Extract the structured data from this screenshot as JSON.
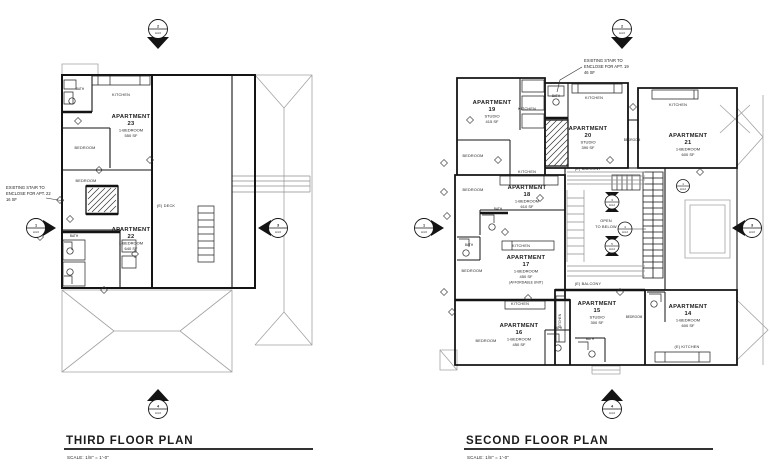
{
  "drawing": {
    "wall_color": "#141414",
    "roof_line_color": "#a3a3a3",
    "text_color": "#1c1c1c",
    "background": "#ffffff"
  },
  "plans": {
    "third": {
      "title": "THIRD FLOOR PLAN",
      "scale_label": "SCALE:   1/8\" = 1'-0\"",
      "annotation": {
        "line1": "EXISTING STAIR TO",
        "line2": "ENCLOSE FOR APT. 22",
        "line3": "16 SF"
      },
      "apartments": [
        {
          "label": "APARTMENT",
          "number": "23",
          "type": "1-BEDROOM",
          "area": "550 SF"
        },
        {
          "label": "APARTMENT",
          "number": "22",
          "type": "1-BEDROOM",
          "area": "640 SF"
        }
      ],
      "rooms": {
        "kitchen23": "KITCHEN",
        "bath23": "BATH",
        "bedroom23": "BEDROOM",
        "bedroom22": "BEDROOM",
        "bath22": "BATH",
        "deck": "(E) DECK"
      }
    },
    "second": {
      "title": "SECOND FLOOR PLAN",
      "scale_label": "SCALE:   1/8\" = 1'-0\"",
      "annotation": {
        "line1": "EXISTING STAIR TO",
        "line2": "ENCLOSE FOR APT. 19",
        "line3": "46 SF"
      },
      "apartments": [
        {
          "label": "APARTMENT",
          "number": "19",
          "type": "STUDIO",
          "area": "415 SF"
        },
        {
          "label": "APARTMENT",
          "number": "20",
          "type": "STUDIO",
          "area": "390 SF"
        },
        {
          "label": "APARTMENT",
          "number": "21",
          "type": "1-BEDROOM",
          "area": "600 SF"
        },
        {
          "label": "APARTMENT",
          "number": "18",
          "type": "1-BEDROOM",
          "area": "610 SF"
        },
        {
          "label": "APARTMENT",
          "number": "17",
          "type": "1-BEDROOM",
          "area": "450 SF",
          "note": "(AFFORDABLE UNIT)"
        },
        {
          "label": "APARTMENT",
          "number": "16",
          "type": "1-BEDROOM",
          "area": "450 SF"
        },
        {
          "label": "APARTMENT",
          "number": "15",
          "type": "STUDIO",
          "area": "300 SF"
        },
        {
          "label": "APARTMENT",
          "number": "14",
          "type": "1-BEDROOM",
          "area": "600 SF"
        }
      ],
      "rooms": {
        "kitchen19": "KITCHEN",
        "bath19": "BATH",
        "bedroom19": "BEDROOM",
        "kitchen20": "KITCHEN",
        "kitchen21": "KITCHEN",
        "bedroom20": "BEDROOM",
        "kitchen18": "KITCHEN",
        "bedroom18": "BEDROOM",
        "bath18": "BATH",
        "kitchen17": "KITCHEN",
        "bedroom17": "BEDROOM",
        "bath17": "BATH",
        "kitchen16": "KITCHEN",
        "bedroom16": "BEDROOM",
        "bath16": "BATH",
        "kitchen15": "KITCHEN",
        "bedroom15": "BEDROOM",
        "bath15": "BATH",
        "kitchen14": "(E) KITCHEN",
        "balcony_top": "(E) BALCONY",
        "balcony_bottom": "(E) BALCONY",
        "open1": "OPEN",
        "open2": "TO BELOW"
      }
    }
  },
  "markers": {
    "elevation": {
      "top": {
        "num": "2",
        "sheet": "A4.0"
      },
      "left": {
        "num": "1",
        "sheet": "A4.0"
      },
      "right": {
        "num": "3",
        "sheet": "A4.0"
      },
      "bottom": {
        "num": "4",
        "sheet": "A4.0"
      }
    },
    "sections": [
      {
        "num": "3",
        "sheet": "A4.2"
      },
      {
        "num": "4",
        "sheet": "A4.2"
      },
      {
        "num": "5",
        "sheet": "A4.2"
      },
      {
        "num": "1",
        "sheet": "A4.2"
      }
    ]
  }
}
